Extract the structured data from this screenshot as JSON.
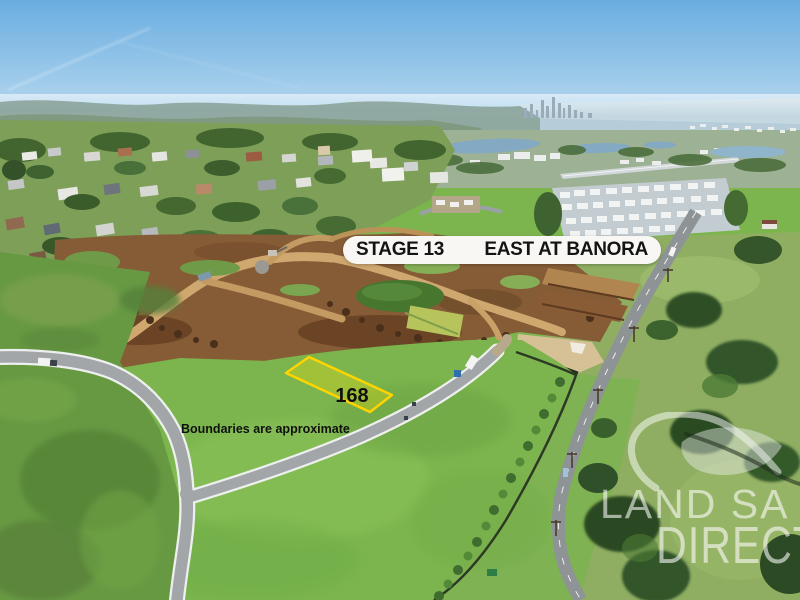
{
  "overlay": {
    "stage_banner": {
      "left_label": "STAGE 13",
      "right_label": "EAST AT BANORA"
    },
    "lot": {
      "number": "168"
    },
    "disclaimer": "Boundaries are approximate",
    "watermark": {
      "line1": "LAND SA",
      "line2": "DIRECT"
    }
  },
  "colors": {
    "lot_outline": "#ffd400",
    "lot_fill": "rgba(255,225,0,0.28)",
    "banner_background": "#f8f7f4",
    "banner_text": "#141414",
    "disclaimer_text": "#101010",
    "watermark_white": "rgba(255,255,255,0.58)"
  }
}
